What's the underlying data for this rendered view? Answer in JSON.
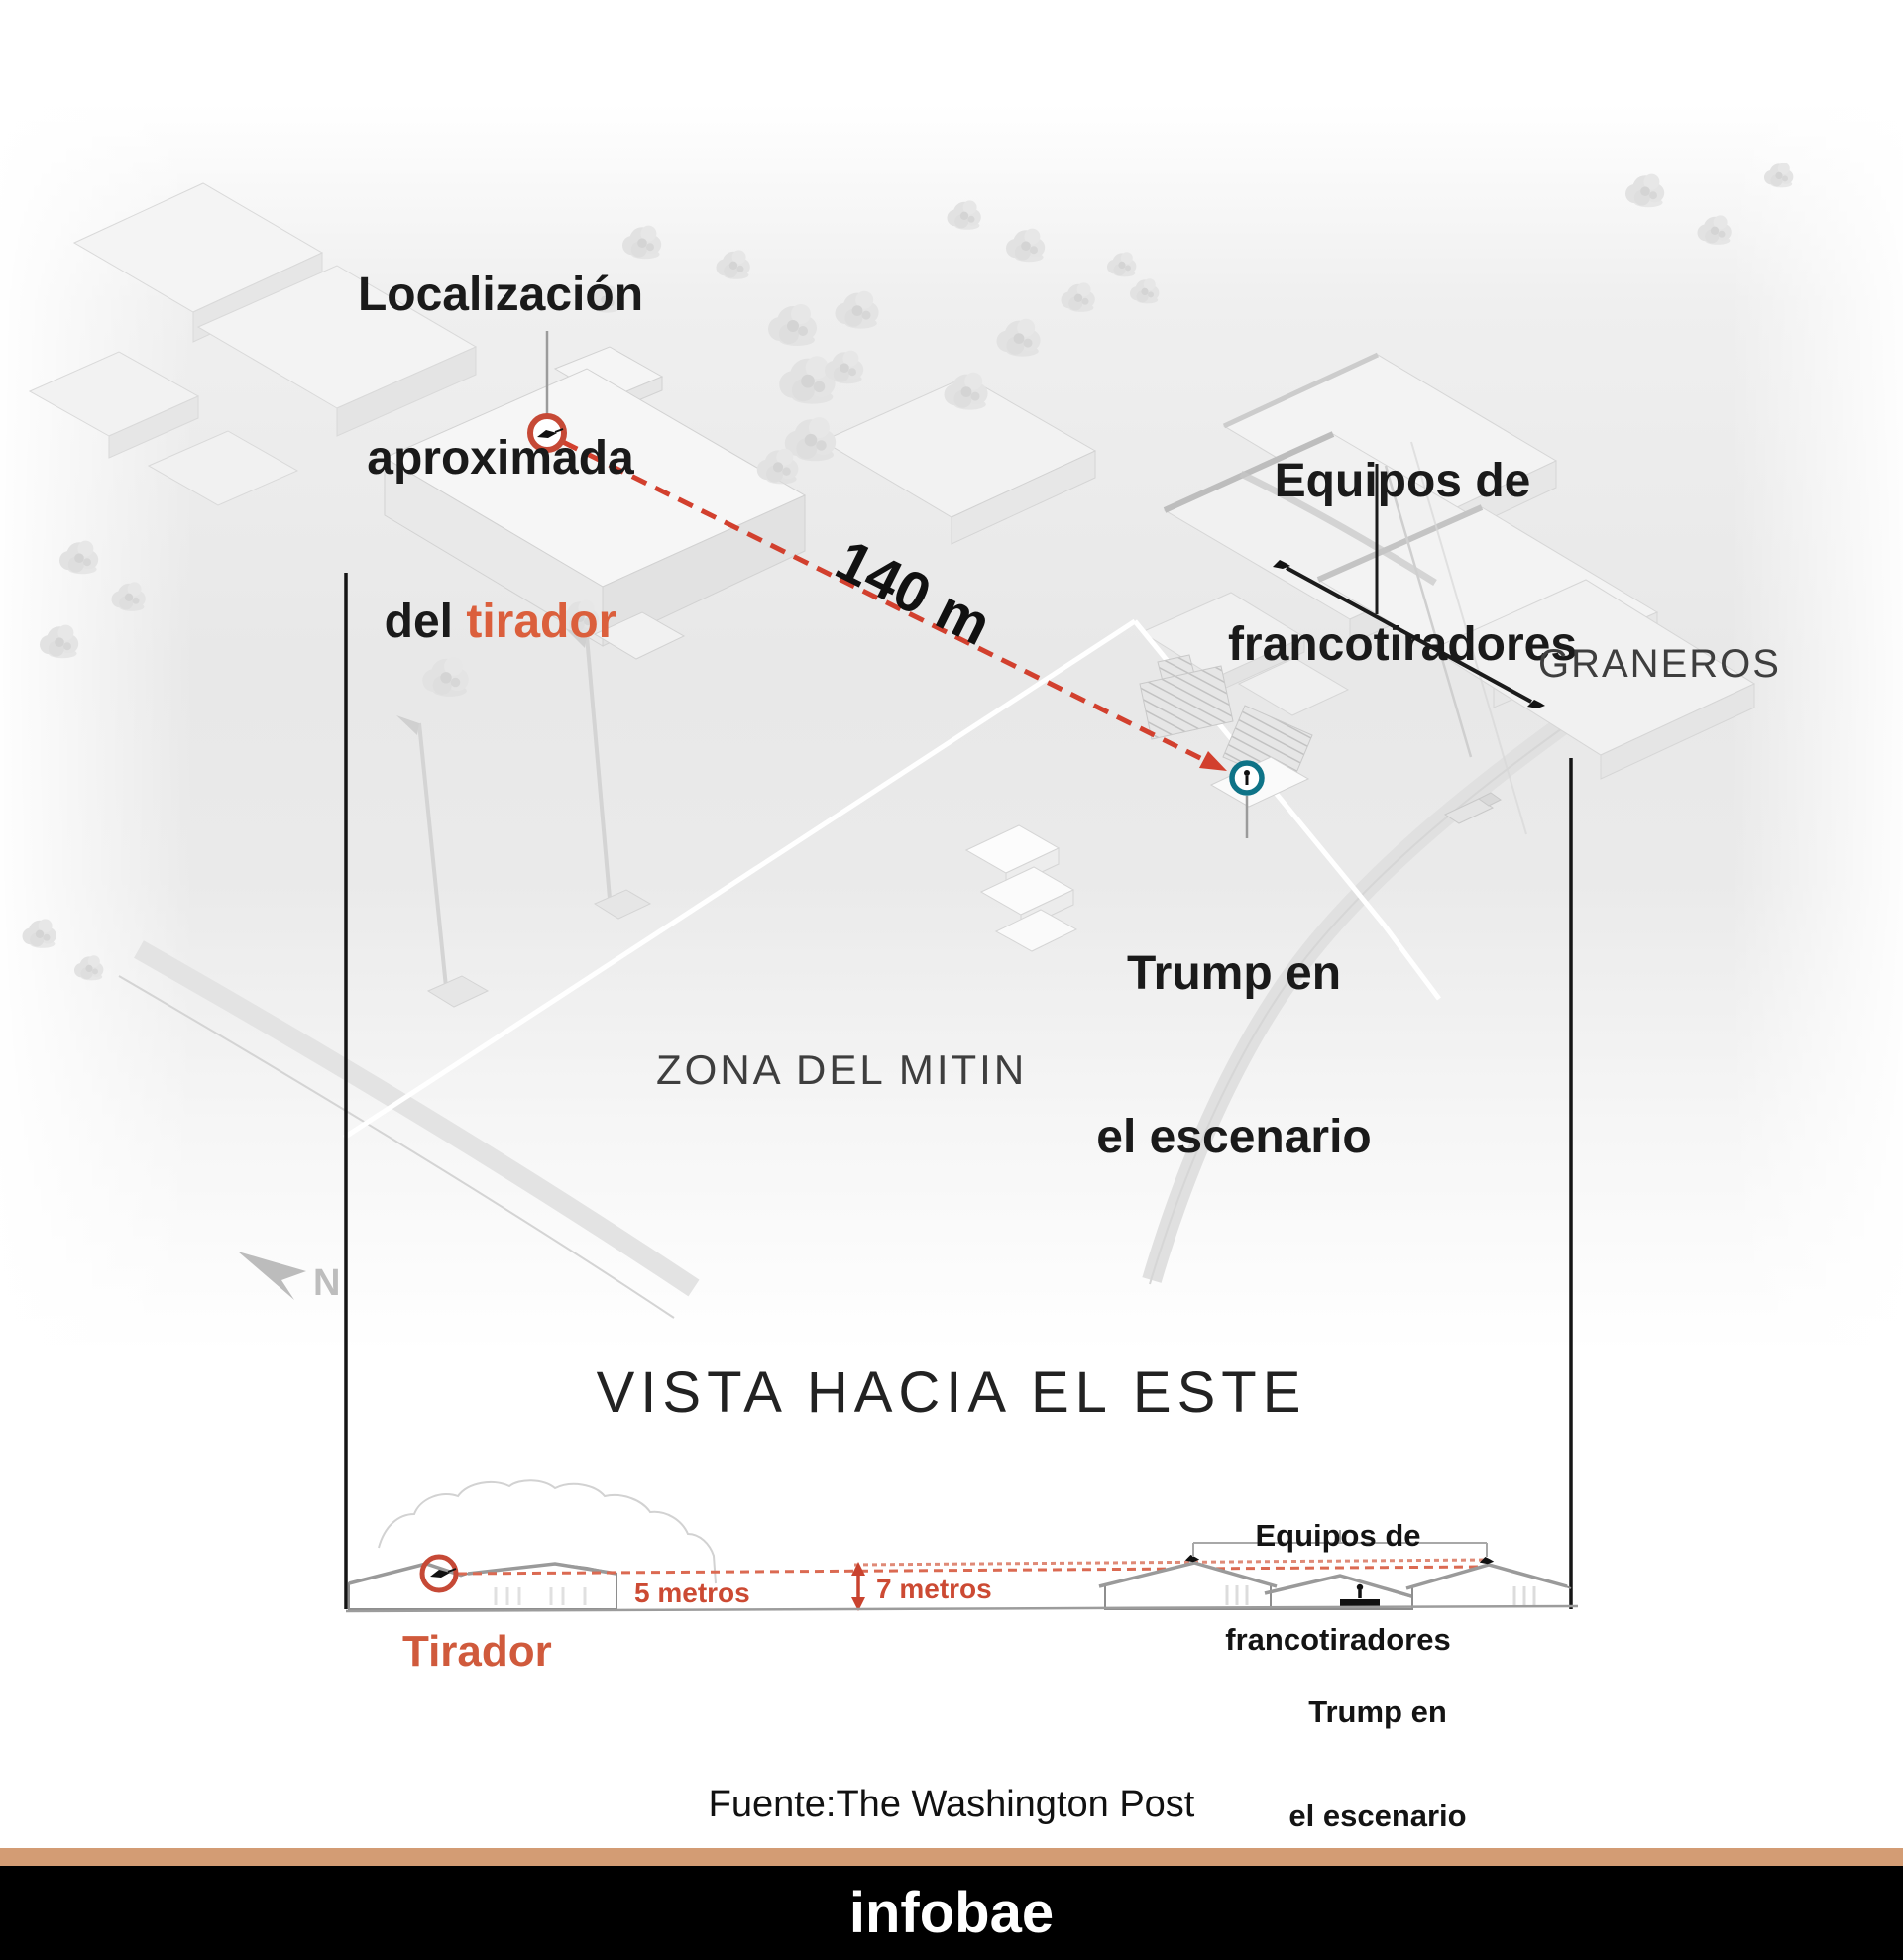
{
  "map": {
    "shooter_location_label": {
      "line1": "Localización",
      "line2": "aproximada",
      "line3_prefix": "del ",
      "line3_accent": "tirador"
    },
    "sniper_teams_label": {
      "line1": "Equipos de",
      "line2": "francotiradores"
    },
    "barns_label": "GRANEROS",
    "distance_label": "140 m",
    "trump_stage_label": {
      "line1": "Trump en",
      "line2": "el escenario"
    },
    "rally_zone_label": "ZONA DEL MITIN",
    "north_label": "N"
  },
  "section": {
    "title": "VISTA HACIA EL ESTE",
    "sniper_teams_label": {
      "line1": "Equipos de",
      "line2": "francotiradores"
    },
    "shooter_height_label": "5 metros",
    "sniper_height_label": "7 metros",
    "shooter_label": "Tirador",
    "trump_stage_label": {
      "line1": "Trump en",
      "line2": "el escenario"
    }
  },
  "source_label": "Fuente:The Washington Post",
  "footer": {
    "brand": "infobae"
  },
  "colors": {
    "accent_orange": "#DB5F3C",
    "dash_red": "#D2402E",
    "marker_red": "#C64936",
    "trump_teal": "#0E7387",
    "footer_bar": "#D39C74",
    "footer_bg": "#000000",
    "label_black": "#1A1A1A",
    "thin_gray": "#3E3E3E"
  }
}
